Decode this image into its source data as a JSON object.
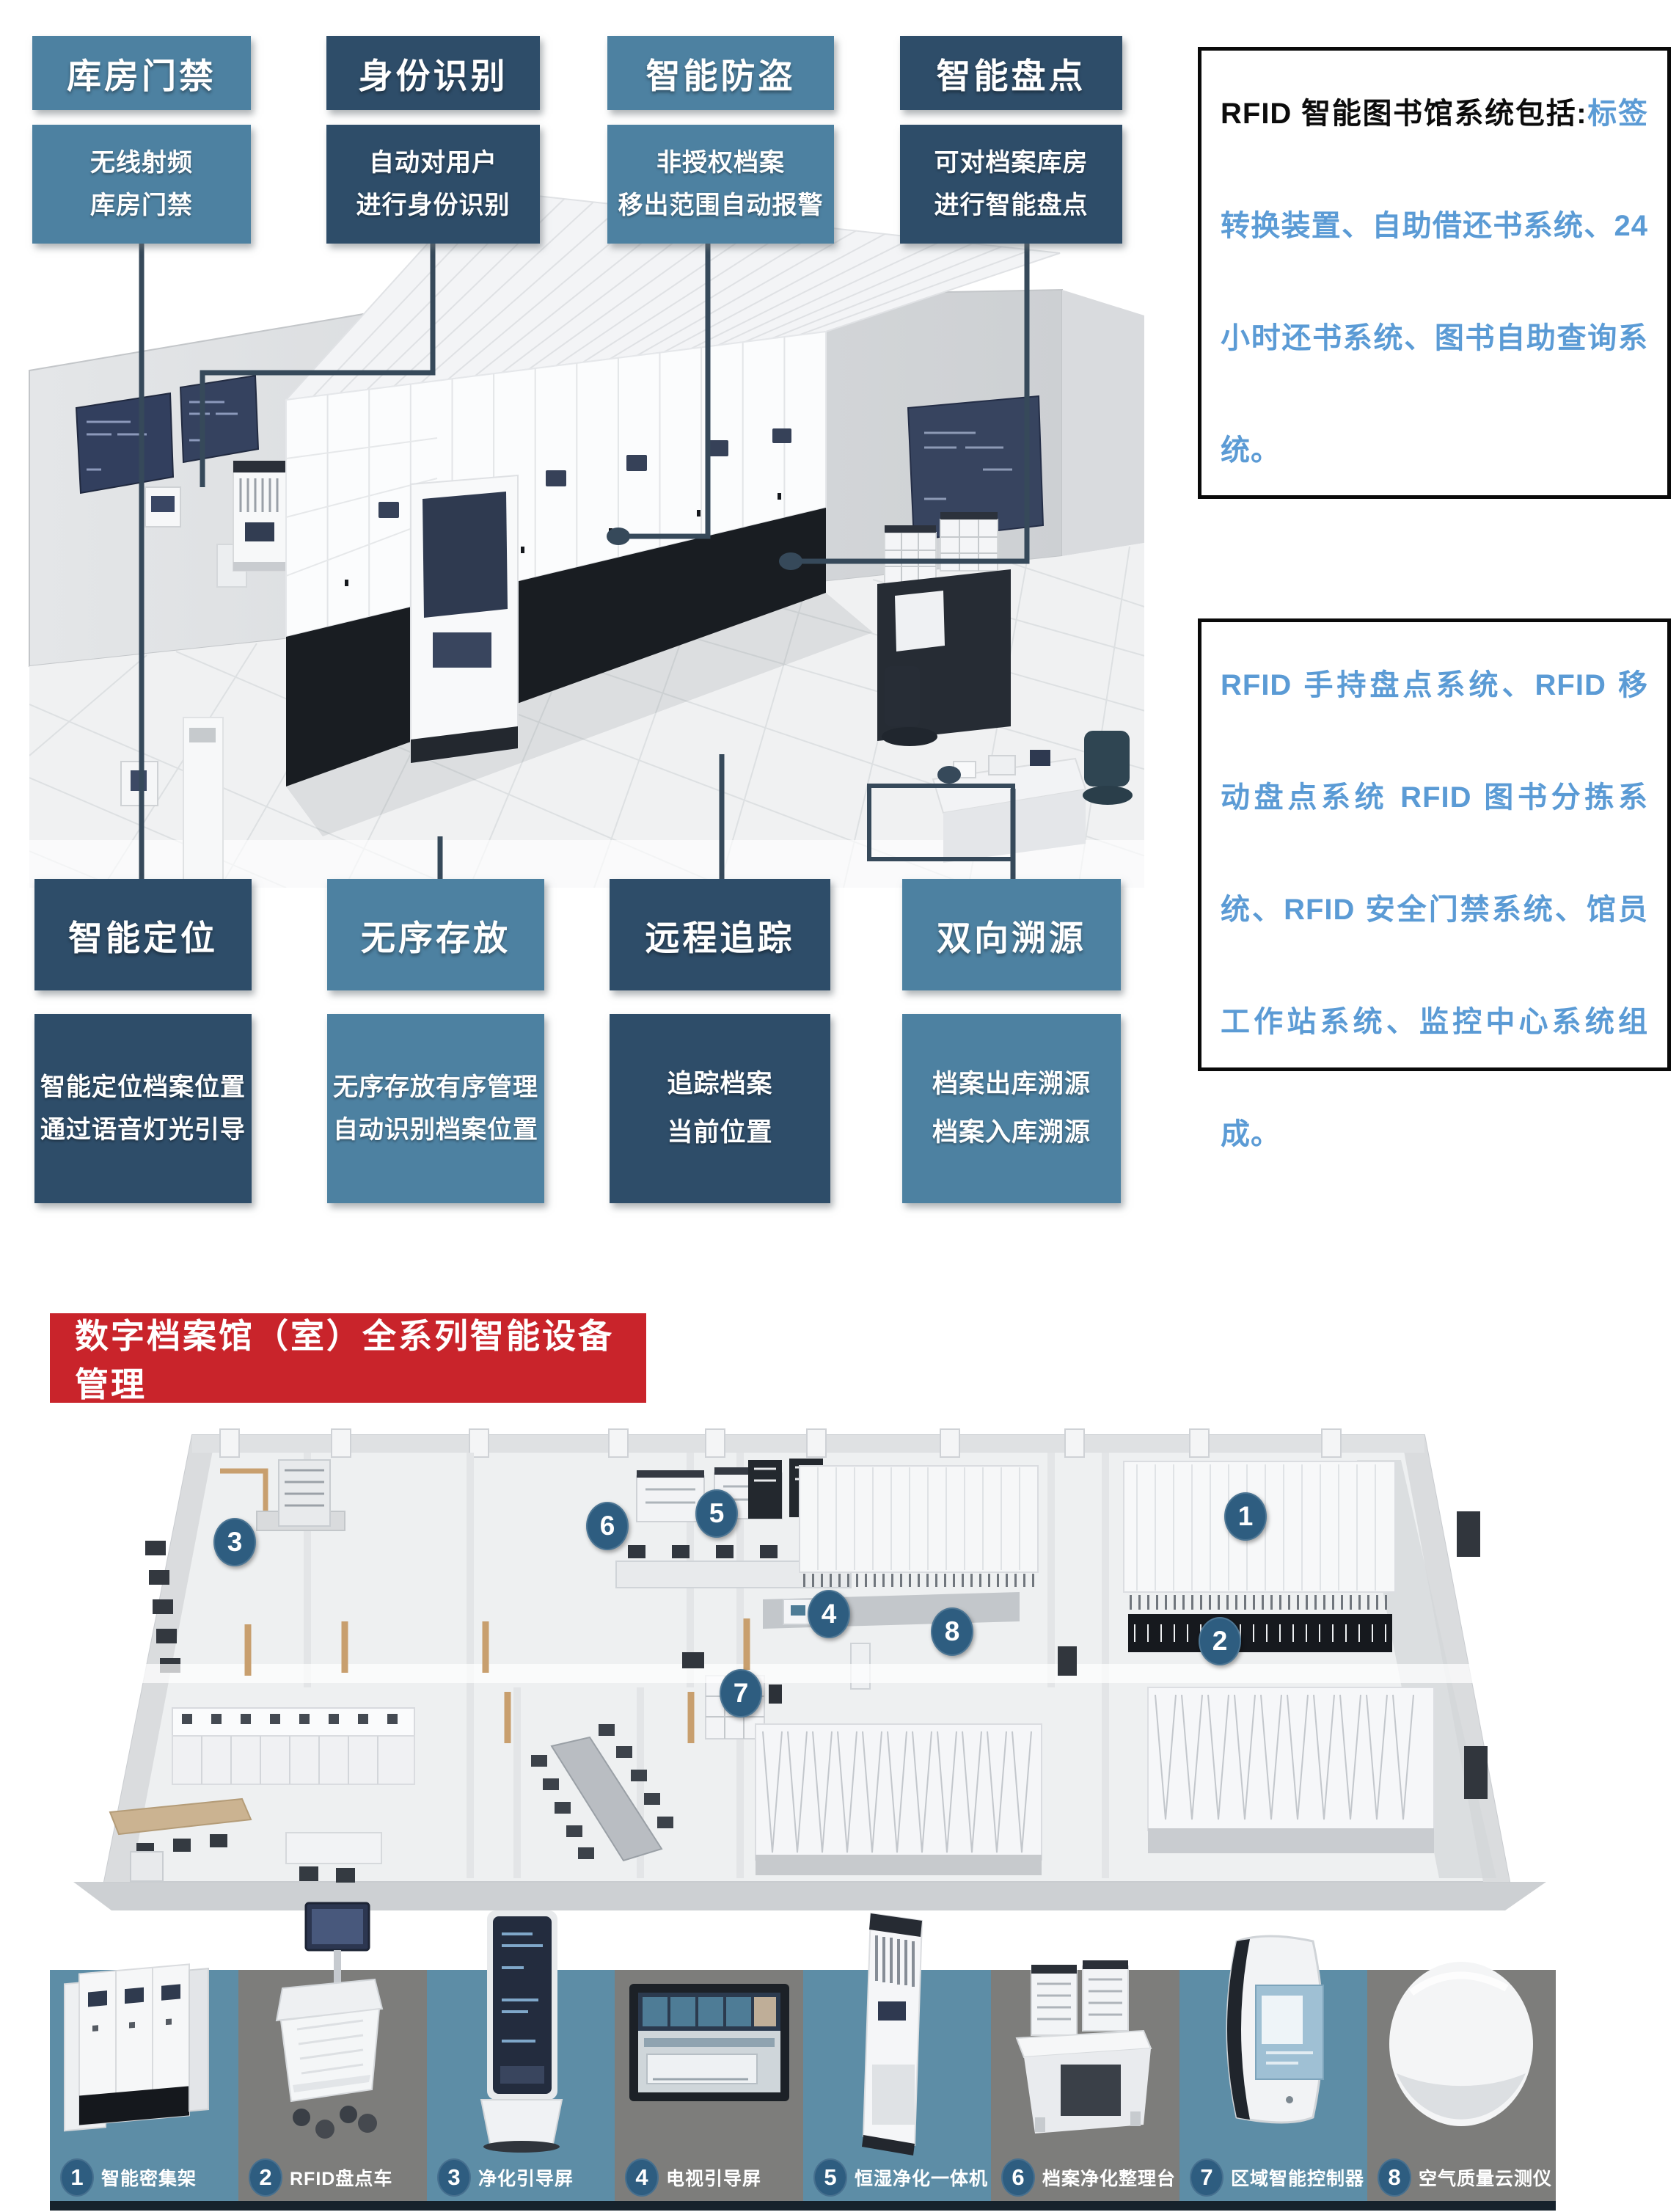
{
  "colors": {
    "teal_box": "#4d81a1",
    "navy_box": "#2e4d69",
    "accent_blue": "#5b9bd5",
    "banner_red": "#c9242b",
    "tile_teal": "#5d8da6",
    "tile_gray": "#7d7d7b",
    "marker_blue": "#2e5d80",
    "connector_slate": "#36495a"
  },
  "top_features": [
    {
      "title": "库房门禁",
      "line1": "无线射频",
      "line2": "库房门禁"
    },
    {
      "title": "身份识别",
      "line1": "自动对用户",
      "line2": "进行身份识别"
    },
    {
      "title": "智能防盗",
      "line1": "非授权档案",
      "line2": "移出范围自动报警"
    },
    {
      "title": "智能盘点",
      "line1": "可对档案库房",
      "line2": "进行智能盘点"
    }
  ],
  "bottom_features": [
    {
      "title": "智能定位",
      "line1": "智能定位档案位置",
      "line2": "通过语音灯光引导"
    },
    {
      "title": "无序存放",
      "line1": "无序存放有序管理",
      "line2": "自动识别档案位置"
    },
    {
      "title": "远程追踪",
      "line1": "追踪档案",
      "line2": "当前位置"
    },
    {
      "title": "双向溯源",
      "line1": "档案出库溯源",
      "line2": "档案入库溯源"
    }
  ],
  "info_box_1": {
    "lead": "RFID 智能图书馆系统包括:",
    "body": "标签转换装置、自助借还书系统、24 小时还书系统、图书自助查询系统。"
  },
  "info_box_2": {
    "body": "RFID 手持盘点系统、RFID 移动盘点系统 RFID 图书分拣系统、RFID 安全门禁系统、馆员工作站系统、监控中心系统组成。"
  },
  "banner": {
    "title": "数字档案馆（室）全系列智能设备管理"
  },
  "floorplan_markers": [
    {
      "n": "1"
    },
    {
      "n": "2"
    },
    {
      "n": "3"
    },
    {
      "n": "4"
    },
    {
      "n": "5"
    },
    {
      "n": "6"
    },
    {
      "n": "7"
    },
    {
      "n": "8"
    }
  ],
  "equipment": [
    {
      "num": "1",
      "label": "智能密集架"
    },
    {
      "num": "2",
      "label": "RFID盘点车"
    },
    {
      "num": "3",
      "label": "净化引导屏"
    },
    {
      "num": "4",
      "label": "电视引导屏"
    },
    {
      "num": "5",
      "label": "恒湿净化一体机"
    },
    {
      "num": "6",
      "label": "档案净化整理台"
    },
    {
      "num": "7",
      "label": "区域智能控制器"
    },
    {
      "num": "8",
      "label": "空气质量云测仪"
    }
  ]
}
